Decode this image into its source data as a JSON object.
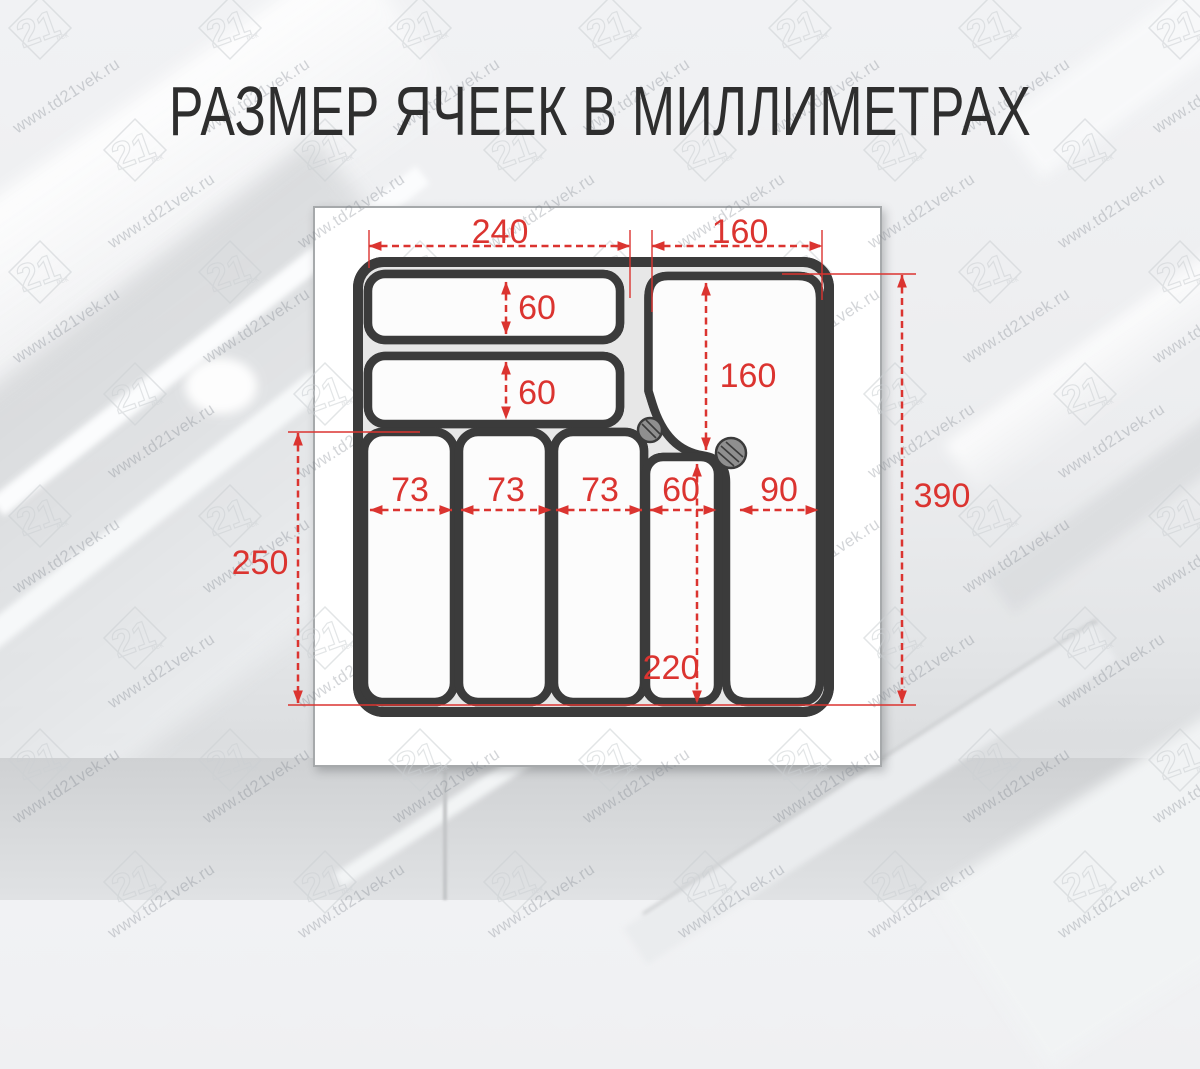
{
  "title": "РАЗМЕР ЯЧЕЕК В МИЛЛИМЕТРАХ",
  "watermark": {
    "text": "www.td21vek.ru",
    "logo_number": "21",
    "logo_caption": "век"
  },
  "colors": {
    "dimension_red": "#db3430",
    "wall_dark": "#3b3b3b",
    "panel_border": "#a6a9ab"
  },
  "diagram": {
    "unit": "mm",
    "dims": {
      "top_left_width": "240",
      "top_right_width": "160",
      "tray1_height": "60",
      "tray2_height": "60",
      "right_section_height": "160",
      "col1_width": "73",
      "col2_width": "73",
      "col3_width": "73",
      "col4_width": "60",
      "col5_width": "90",
      "col4_height": "220",
      "left_height": "250",
      "right_total_height": "390"
    }
  }
}
